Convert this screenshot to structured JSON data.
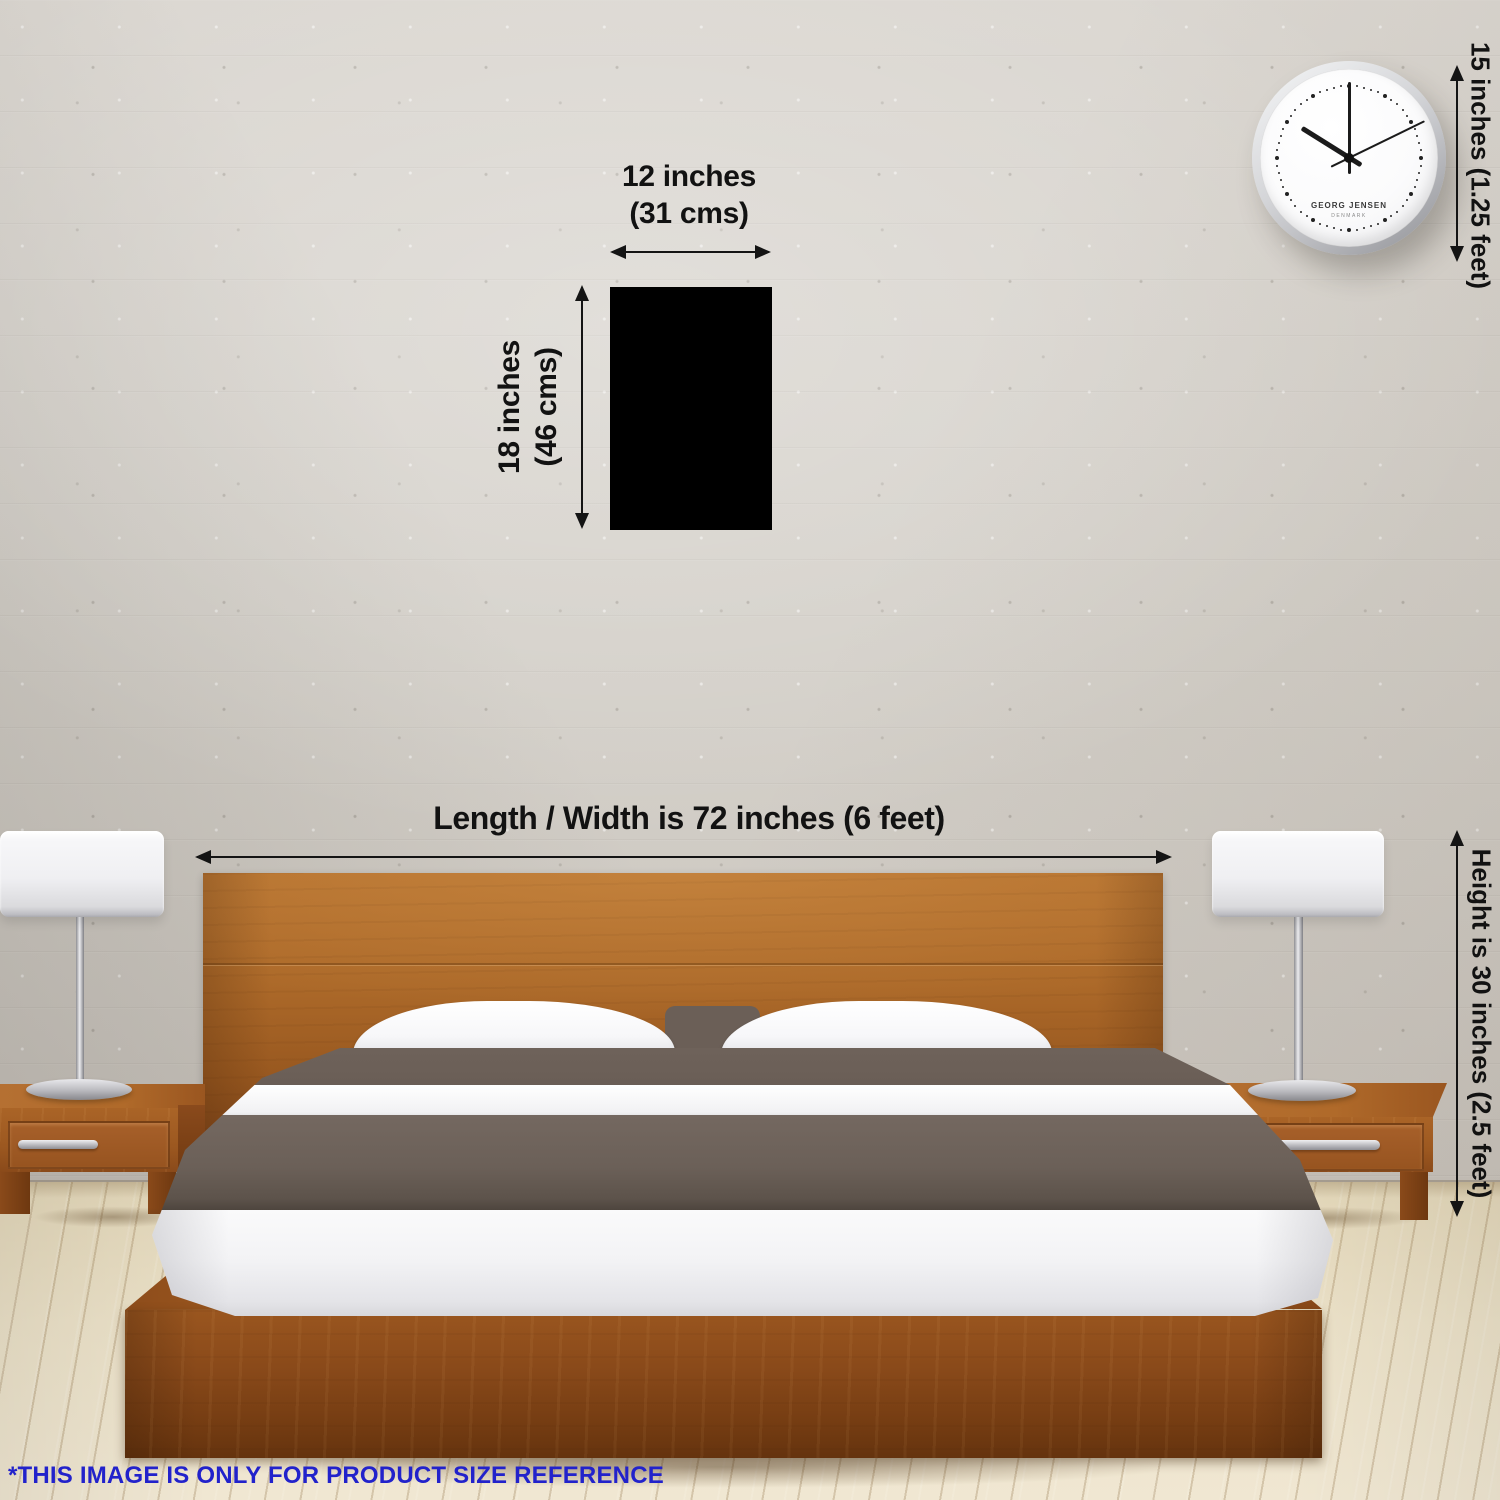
{
  "annotations": {
    "product_width": {
      "line1": "12 inches",
      "line2": "(31 cms)"
    },
    "product_height": {
      "line1": "18 inches",
      "line2": "(46 cms)"
    },
    "clock_height": "15 inches (1.25 feet)",
    "bed_width": "Length / Width is 72 inches (6 feet)",
    "bed_height": "Height is 30 inches (2.5 feet)",
    "footnote": "*THIS IMAGE IS ONLY FOR PRODUCT SIZE REFERENCE"
  },
  "clock": {
    "brand_line1": "GEORG JENSEN",
    "brand_line2": "DENMARK"
  },
  "colors": {
    "annotation_text": "#121212",
    "footnote_text": "#2222cb",
    "product_swatch": "#000000",
    "wall": "#d3cfc8",
    "floor": "#ebe1c8",
    "wood": "#9c5820",
    "blanket": "#6b6058",
    "sheet": "#f3f3f5"
  }
}
